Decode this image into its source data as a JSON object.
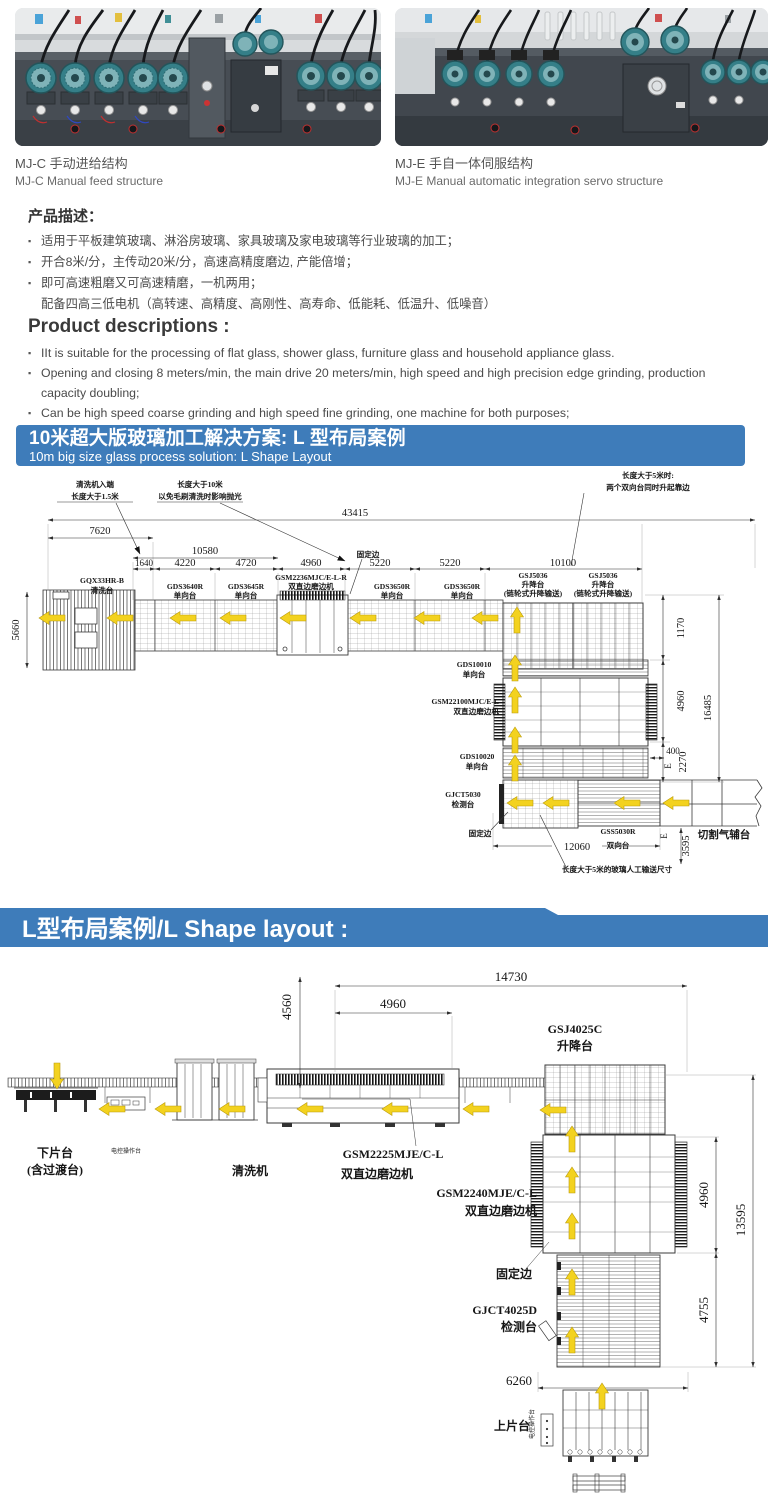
{
  "colors": {
    "blue": "#3e7cba",
    "arrow": "#f3d21f",
    "line": "#3b3b3b"
  },
  "photos": {
    "left": {
      "caption_zh": "MJ-C 手动进给结构",
      "caption_en": "MJ-C Manual feed structure"
    },
    "right": {
      "caption_zh": "MJ-E 手自一体伺服结构",
      "caption_en": "MJ-E Manual automatic integration servo structure"
    }
  },
  "desc_zh": {
    "heading": "产品描述：",
    "bullets": [
      "适用于平板建筑玻璃、淋浴房玻璃、家具玻璃及家电玻璃等行业玻璃的加工；",
      "开合8米/分，主传动20米/分，高速高精度磨边, 产能倍增；",
      "即可高速粗磨又可高速精磨，一机两用；"
    ],
    "cont": "配备四高三低电机（高转速、高精度、高刚性、高寿命、低能耗、低温升、低噪音）"
  },
  "desc_en": {
    "heading": "Product descriptions :",
    "bullets": [
      "IIt is suitable for the processing of flat glass, shower glass, furniture glass and household appliance glass.",
      "Opening and closing 8 meters/min, the main drive 20 meters/min, high speed and high precision edge grinding, production capacity doubling;",
      "Can be high speed coarse grinding and high speed fine grinding, one machine for both purposes;"
    ],
    "cont": "Equipped with four three low motor (high speed, high precision, high rigidity, high life, low energy consumption, low temperature rise, low noise)"
  },
  "banner1": {
    "zh": "10米超大版玻璃加工解决方案: L 型布局案例",
    "en": "10m big size glass process solution: L Shape Layout"
  },
  "banner2": {
    "text": "L型布局案例/L Shape layout :"
  },
  "d1": {
    "notes": {
      "inlet1": "清洗机入端",
      "inlet2": "长度大于1.5米",
      "ten1": "长度大于10米",
      "ten2": "以免毛刷清洗时影响抛光",
      "five1": "长度大于5米时:",
      "five2": "两个双向台同时升起靠边",
      "fixed_top": "固定边",
      "fixed_bottom": "固定边",
      "manual": "长度大于5米的玻璃人工输送尺寸",
      "cutting": "切割气辅台",
      "emark": "E"
    },
    "dims": {
      "total": "43415",
      "d7620": "7620",
      "d10580": "10580",
      "d1640": "1640",
      "d4220": "4220",
      "d4720": "4720",
      "d4960": "4960",
      "d5220a": "5220",
      "d5220b": "5220",
      "d10100": "10100",
      "left": "5660",
      "r1170": "1170",
      "r4960": "4960",
      "r16485": "16485",
      "r400": "400",
      "r2270": "2270",
      "b12060": "12060",
      "b3595": "3595"
    },
    "m": {
      "wash": {
        "l1": "GQX33HR-B",
        "l2": "清洗台"
      },
      "t1": {
        "l1": "GDS3640R",
        "l2": "单向台"
      },
      "t2": {
        "l1": "GDS3645R",
        "l2": "单向台"
      },
      "edger1": {
        "l1": "GSM2236MJC/E-L-R",
        "l2": "双直边磨边机"
      },
      "t3": {
        "l1": "GDS3650R",
        "l2": "单向台"
      },
      "t4": {
        "l1": "GDS3650R",
        "l2": "单向台"
      },
      "lift1": {
        "l1": "GSJ5036",
        "l2": "升降台",
        "l3": "(链轮式升降输送)"
      },
      "lift2": {
        "l1": "GSJ5036",
        "l2": "升降台",
        "l3": "(链轮式升降输送)"
      },
      "t5": {
        "l1": "GDS10010",
        "l2": "单向台"
      },
      "edger2": {
        "l1": "GSM22100MJC/E-L",
        "l2": "双直边磨边机"
      },
      "t6": {
        "l1": "GDS10020",
        "l2": "单向台"
      },
      "inspect": {
        "l1": "GJCT5030",
        "l2": "检测台"
      },
      "bi": {
        "l1": "GSS5030R",
        "l2": "双向台"
      }
    }
  },
  "d2": {
    "dims": {
      "t14730": "14730",
      "t4960": "4960",
      "v4560": "4560",
      "r4960": "4960",
      "r13595": "13595",
      "r4755": "4755",
      "b6260": "6260"
    },
    "labels": {
      "lift": {
        "l1": "GSJ4025C",
        "l2": "升降台"
      },
      "unload1": "下片台",
      "unload2": "(含过渡台)",
      "console": "电控操作台",
      "wash": "清洗机",
      "edger1": {
        "l1": "GSM2225MJE/C-L",
        "l2": "双直边磨边机"
      },
      "edger2": {
        "l1": "GSM2240MJE/C-L",
        "l2": "双直边磨边机"
      },
      "fixed": "固定边",
      "inspect": {
        "l1": "GJCT4025D",
        "l2": "检测台"
      },
      "load": "上片台",
      "console2": "电控操作台"
    }
  }
}
